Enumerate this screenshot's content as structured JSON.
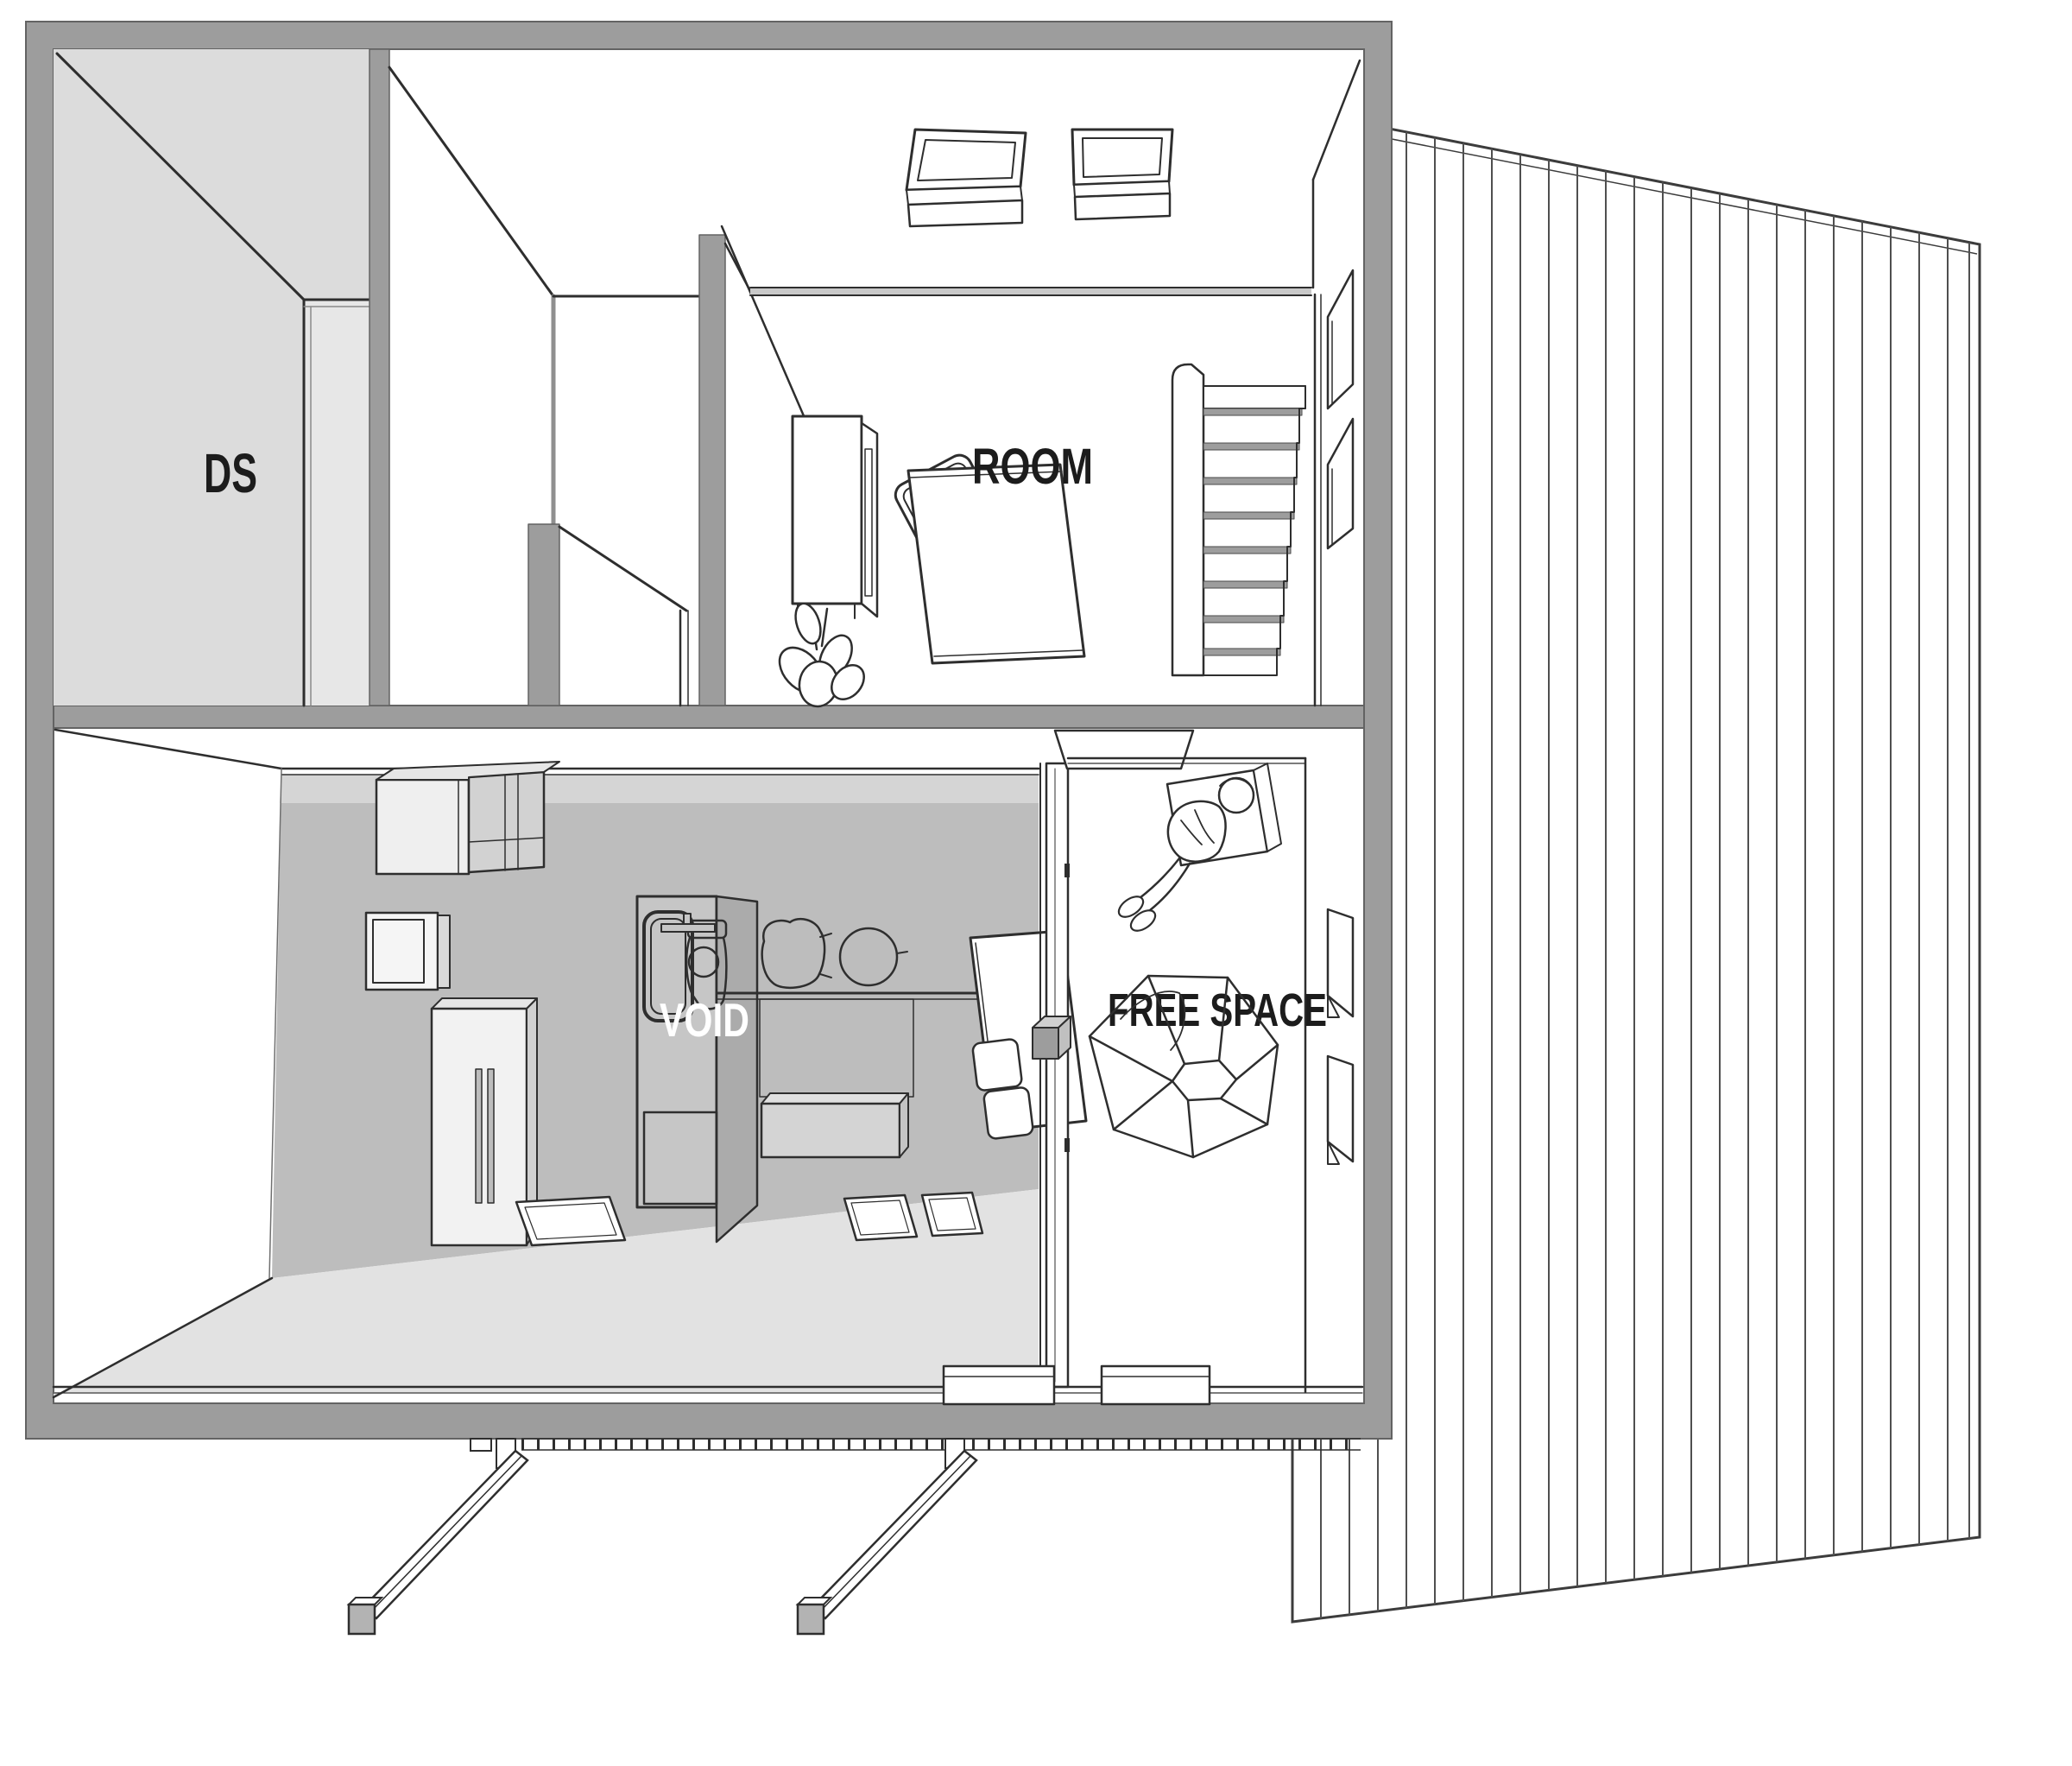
{
  "drawing": {
    "kind": "axonometric cutaway floor plan",
    "palette": {
      "background": "#ffffff",
      "wall_gray": "#9d9d9d",
      "wall_edge": "#636363",
      "line_dark": "#2e2e2e",
      "ds_fill": "#dcdcdc",
      "interior_wall": "#bdbdbd",
      "interior_light": "#d5d5d5",
      "floor_light": "#e2e2e2",
      "unit_face": "#c6c6c6",
      "unit_side": "#ababab"
    },
    "labels": {
      "ds": {
        "text": "DS",
        "color": "#1c1c1c"
      },
      "room": {
        "text": "ROOM",
        "color": "#1c1c1c"
      },
      "void": {
        "text": "VOID",
        "color": "#ffffff"
      },
      "free_space": {
        "text": "FREE SPACE",
        "color": "#1c1c1c"
      }
    }
  }
}
